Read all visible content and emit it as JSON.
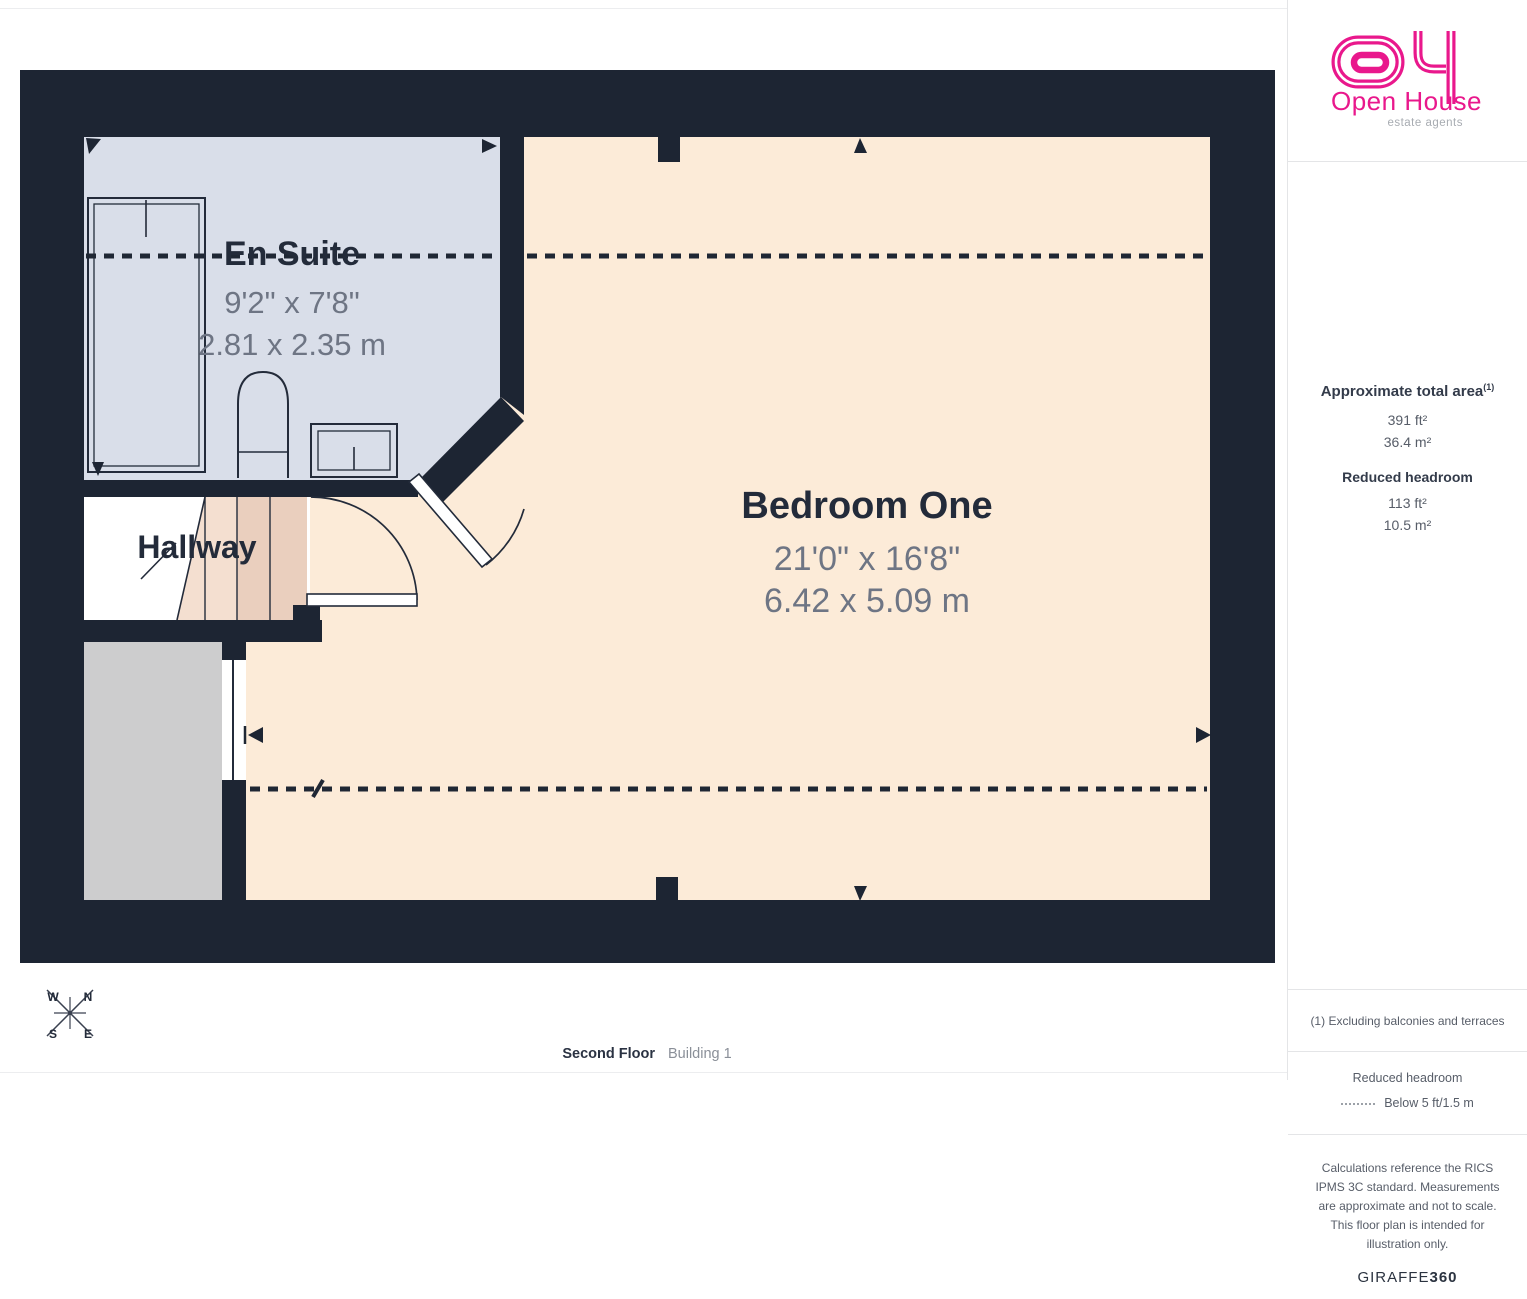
{
  "rooms": {
    "ensuite": {
      "name": "En Suite",
      "imperial": "9'2\" x 7'8\"",
      "metric": "2.81 x 2.35 m"
    },
    "bedroom": {
      "name": "Bedroom One",
      "imperial": "21'0\" x 16'8\"",
      "metric": "6.42 x 5.09 m"
    },
    "hallway": {
      "name": "Hallway"
    }
  },
  "footer": {
    "floor": "Second Floor",
    "building": "Building 1"
  },
  "logo": {
    "brand": "Open House",
    "tagline": "estate agents"
  },
  "sidebar": {
    "area_title": "Approximate total area",
    "area_sup": "(1)",
    "area_ft": "391 ft²",
    "area_m": "36.4 m²",
    "reduced_title": "Reduced headroom",
    "reduced_ft": "113 ft²",
    "reduced_m": "10.5 m²",
    "note": "(1) Excluding balconies and terraces",
    "legend_title": "Reduced headroom",
    "legend_label": "Below 5 ft/1.5 m",
    "disclaimer": "Calculations reference the RICS IPMS 3C standard. Measurements are approximate and not to scale. This floor plan is intended for illustration only.",
    "brand": "GIRAFFE",
    "brand_suffix": "360"
  },
  "compass": {
    "n": "N",
    "e": "E",
    "s": "S",
    "w": "W"
  },
  "colors": {
    "wall": "#1D2533",
    "ensuite_floor": "#D9DEE9",
    "bedroom_floor": "#FCEBD8",
    "stairs_light": "#F4DFD0",
    "stairs_dark": "#EACFBE",
    "void_room": "#CDCDCE",
    "brand_pink": "#E9188C"
  }
}
